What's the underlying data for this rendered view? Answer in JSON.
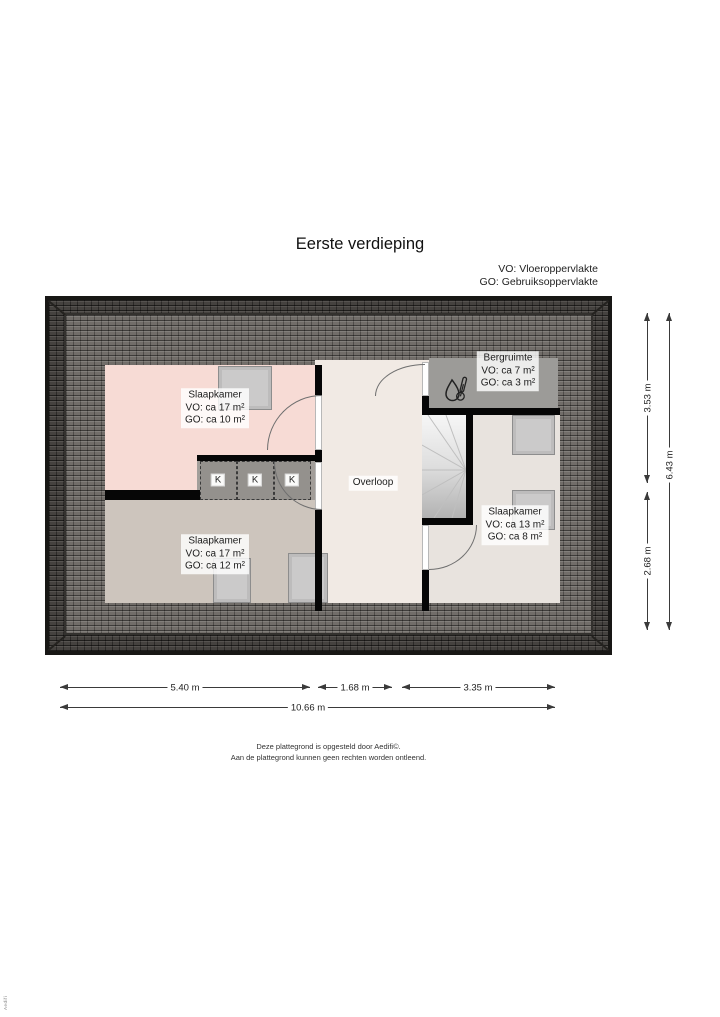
{
  "title": "Eerste verdieping",
  "legend": {
    "vo": "VO: Vloeroppervlakte",
    "go": "GO: Gebruiksoppervlakte"
  },
  "rooms": {
    "nw": {
      "name": "Slaapkamer",
      "vo": "VO: ca 17 m²",
      "go": "GO: ca 10 m²"
    },
    "sw": {
      "name": "Slaapkamer",
      "vo": "VO: ca 17 m²",
      "go": "GO: ca 12 m²"
    },
    "east": {
      "name": "Slaapkamer",
      "vo": "VO: ca 13 m²",
      "go": "GO: ca 8 m²"
    },
    "bergruimte": {
      "name": "Bergruimte",
      "vo": "VO: ca 7 m²",
      "go": "GO: ca 3 m²"
    },
    "overloop": {
      "name": "Overloop"
    }
  },
  "closets": [
    "K",
    "K",
    "K"
  ],
  "dimensions": {
    "right_upper": "3.53 m",
    "right_lower": "2.68 m",
    "right_total": "6.43 m",
    "bottom_left": "5.40 m",
    "bottom_middle": "1.68 m",
    "bottom_right": "3.35 m",
    "bottom_total": "10.66 m"
  },
  "footer": {
    "line1": "Deze plattegrond is opgesteld door Aedifi©.",
    "line2": "Aan de plattegrond kunnen geen rechten worden ontleend."
  },
  "edge_text": "Aedifi",
  "colors": {
    "roof_dark": "#45423f",
    "roof_light": "#716d69",
    "room_pink": "#f7dbd5",
    "room_beige": "#cdc5bd",
    "room_cream": "#f1eae4",
    "room_greige": "#e8e3de",
    "room_gray": "#9c9b98",
    "wall": "#060606"
  }
}
